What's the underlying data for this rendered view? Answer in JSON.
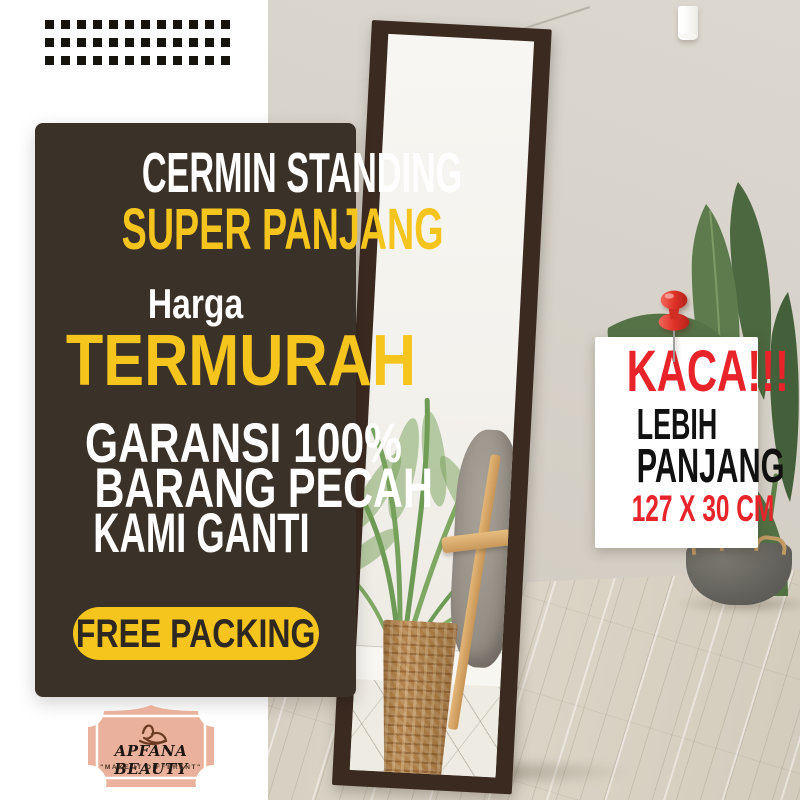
{
  "promo_panel": {
    "title_line1": "CERMIN STANDING",
    "title_line2": "SUPER PANJANG",
    "price_label": "Harga",
    "price_highlight": "TERMURAH",
    "guarantee": [
      "GARANSI 100%",
      "BARANG PECAH",
      "KAMI GANTI"
    ],
    "button_label": "FREE PACKING"
  },
  "size_card": {
    "headline": "KACA!!!",
    "line1": "LEBIH",
    "line2": "PANJANG",
    "dimensions": "127 X 30 CM"
  },
  "logo": {
    "name": "APFANA BEAUTY",
    "tagline": "\"MAKE IT DIFFERENT\""
  },
  "icons": {
    "pushpin": "3d-red-pushpin",
    "brand_mark": "brush-figure-monogram"
  },
  "decor": {
    "dots_rows": 3,
    "dots_cols": 12
  },
  "colors": {
    "panel-bg": "#3A3129",
    "accent-yellow": "#F6C51D",
    "accent-red": "#E8232A",
    "text-dark": "#2E2822",
    "logo-salmon": "#EAB29C",
    "wall": "#D6D1C8",
    "frame-brown": "#3B2A20",
    "basket-tan": "#B5854D"
  }
}
